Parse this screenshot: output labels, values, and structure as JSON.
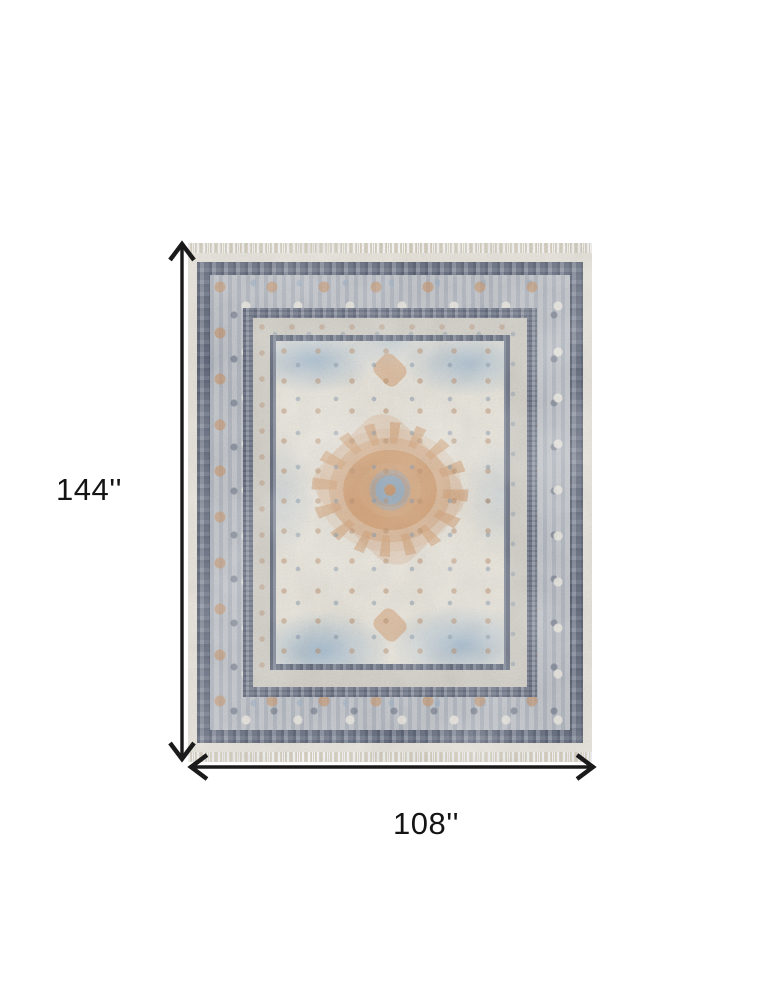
{
  "diagram": {
    "kind": "product-dimension-diagram",
    "background": "#ffffff",
    "height_label": "144''",
    "width_label": "108''",
    "arrow_color": "#1a1a1a",
    "text_color": "#141414"
  },
  "rug": {
    "description": "Distressed vintage-style medallion area rug with fringe on top and bottom edges",
    "colors": {
      "edge_ivory": "#e5e1d8",
      "border_dark": "#7a8294",
      "ornate_band": "#b7bcc4",
      "taupe_band": "#cfccc4",
      "guard_dark": "#737b8c",
      "field_ivory": "#e6e2d8",
      "field_blue": "#94b0c9",
      "medallion_orange": "#cf9c6e",
      "medallion_core_blue": "#8fa4b6",
      "fringe": "#d8d1c0"
    }
  }
}
